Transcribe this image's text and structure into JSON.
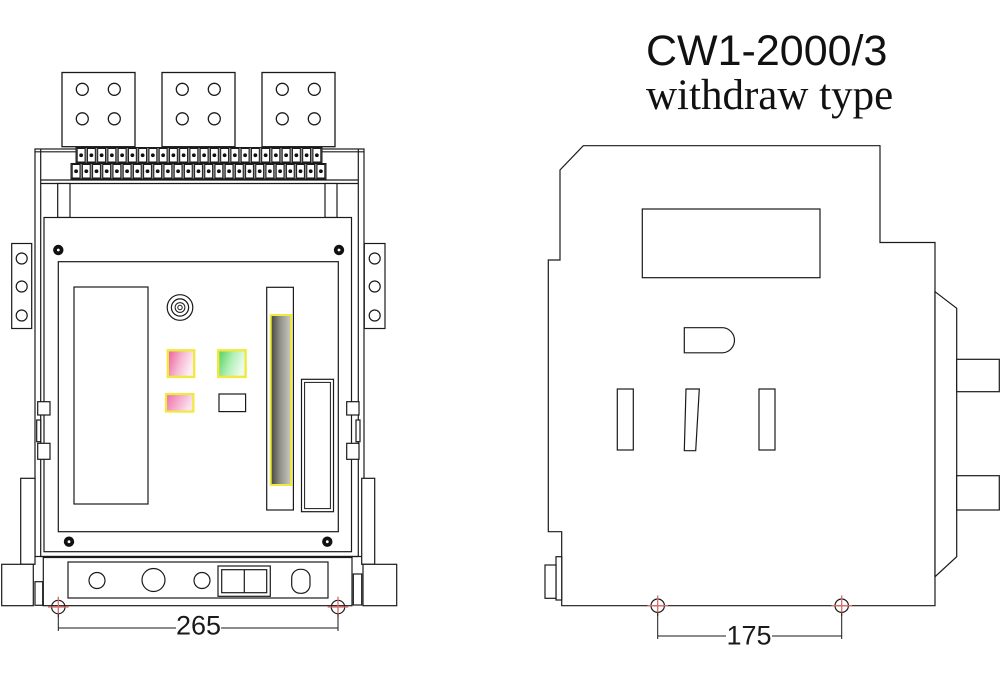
{
  "title": {
    "model": "CW1-2000/3",
    "type_label": "withdraw type"
  },
  "front_view": {
    "dimension_mm": "265",
    "bus_terminals": {
      "count": 3,
      "holes_per_terminal": 4
    },
    "terminal_rows": [
      {
        "count": 24
      },
      {
        "count": 25
      }
    ],
    "bracket_holes_per_side": 3
  },
  "side_view": {
    "dimension_mm": "175"
  },
  "colors": {
    "line": "#1a1a1a",
    "marker_red": "#d96b6b",
    "indicator_border_yellow": "#f0e93f",
    "pink_start": "#eb5a9a",
    "pink_mid": "#f6b8d3",
    "pink_end": "#fdeff5",
    "pink2_start": "#ee6ba6",
    "pink2_end": "#fbe3ef",
    "green_start": "#4fd057",
    "green_mid": "#b2efb8",
    "green_end": "#ecfcec",
    "slot_start": "#43433b",
    "slot_mid": "#90908a",
    "slot_end": "#cbcbc3"
  }
}
